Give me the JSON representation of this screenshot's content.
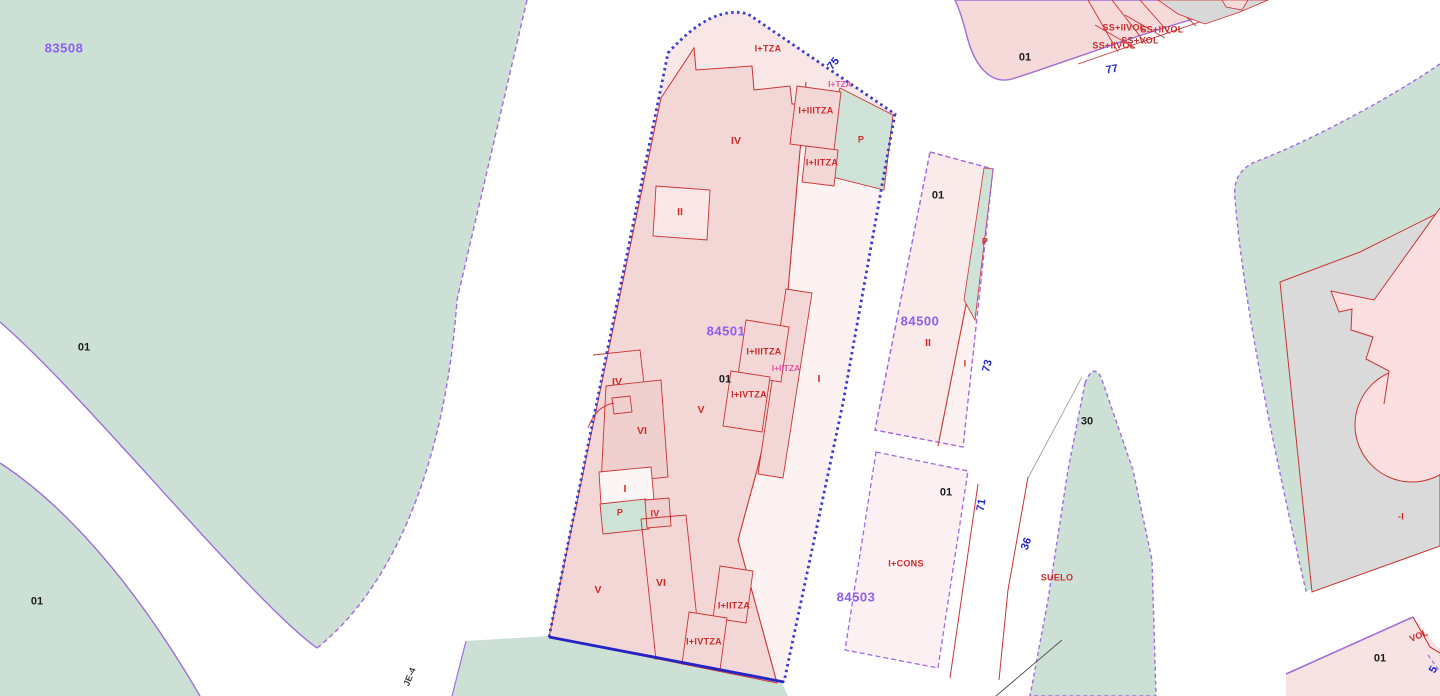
{
  "map": {
    "parcel_codes_visible": [
      "83508",
      "84501",
      "84500",
      "84503"
    ],
    "street_numbers_visible": [
      "75",
      "77",
      "73",
      "71",
      "36",
      "5"
    ],
    "street_name": "JE-4"
  },
  "colors": {
    "green_area": "#cde0d6",
    "parcel_pink_light": "#f9e7e7",
    "building_pink": "#f3d7d7",
    "building_pink_dark": "#f0cfcf",
    "strip_pink_pale": "#fdf2f2",
    "gray_parcel": "#dadada",
    "red_line": "#cc3333",
    "violet_line": "#9f6fd8",
    "selected_parcel_blue": "#3a3ad0",
    "parcel_code_purple": "#8d5ef0",
    "street_number_blue": "#2323cd",
    "magenta_label": "#e0559f"
  },
  "labels": [
    {
      "text": "83508",
      "x": 64,
      "y": 48,
      "cls": "code",
      "name": "parcel-code-label"
    },
    {
      "text": "84501",
      "x": 726,
      "y": 331,
      "cls": "code",
      "name": "parcel-code-label"
    },
    {
      "text": "84500",
      "x": 920,
      "y": 321,
      "cls": "code",
      "name": "parcel-code-label"
    },
    {
      "text": "84503",
      "x": 856,
      "y": 597,
      "cls": "code",
      "name": "parcel-code-label"
    },
    {
      "text": "01",
      "x": 84,
      "y": 348,
      "cls": "lot",
      "name": "lot-number-label"
    },
    {
      "text": "01",
      "x": 37,
      "y": 602,
      "cls": "lot",
      "name": "lot-number-label"
    },
    {
      "text": "01",
      "x": 725,
      "y": 380,
      "cls": "lot",
      "name": "lot-number-label"
    },
    {
      "text": "01",
      "x": 938,
      "y": 196,
      "cls": "lot",
      "name": "lot-number-label"
    },
    {
      "text": "01",
      "x": 946,
      "y": 493,
      "cls": "lot",
      "name": "lot-number-label"
    },
    {
      "text": "01",
      "x": 1025,
      "y": 58,
      "cls": "lot",
      "name": "lot-number-label"
    },
    {
      "text": "01",
      "x": 1380,
      "y": 659,
      "cls": "lot",
      "name": "lot-number-label"
    },
    {
      "text": "30",
      "x": 1087,
      "y": 422,
      "cls": "lot",
      "name": "lot-number-label"
    },
    {
      "text": "75",
      "x": 834,
      "y": 64,
      "cls": "street",
      "rot": -50,
      "name": "street-number-label"
    },
    {
      "text": "77",
      "x": 1112,
      "y": 70,
      "cls": "street",
      "rot": -10,
      "name": "street-number-label"
    },
    {
      "text": "73",
      "x": 988,
      "y": 366,
      "cls": "street",
      "rot": -75,
      "name": "street-number-label"
    },
    {
      "text": "71",
      "x": 982,
      "y": 505,
      "cls": "street",
      "rot": -80,
      "name": "street-number-label"
    },
    {
      "text": "36",
      "x": 1027,
      "y": 544,
      "cls": "street",
      "rot": -70,
      "name": "street-number-label"
    },
    {
      "text": "5",
      "x": 1434,
      "y": 670,
      "cls": "street",
      "rot": -60,
      "name": "street-number-label"
    },
    {
      "text": "JE-4",
      "x": 410,
      "y": 677,
      "cls": "name",
      "rot": -68,
      "name": "street-name-label"
    },
    {
      "text": "I+TZA",
      "x": 768,
      "y": 49,
      "cls": "red",
      "name": "construction-label"
    },
    {
      "text": "I+TZA",
      "x": 840,
      "y": 84,
      "cls": "magenta",
      "name": "construction-label"
    },
    {
      "text": "I+IIITZA",
      "x": 816,
      "y": 111,
      "cls": "red",
      "name": "construction-label"
    },
    {
      "text": "I+IITZA",
      "x": 822,
      "y": 163,
      "cls": "red",
      "name": "construction-label"
    },
    {
      "text": "P",
      "x": 861,
      "y": 140,
      "cls": "red",
      "name": "construction-label"
    },
    {
      "text": "IV",
      "x": 736,
      "y": 141,
      "cls": "red-lg",
      "name": "construction-label"
    },
    {
      "text": "II",
      "x": 680,
      "y": 212,
      "cls": "red-lg",
      "name": "construction-label"
    },
    {
      "text": "I+IIITZA",
      "x": 764,
      "y": 352,
      "cls": "red",
      "name": "construction-label"
    },
    {
      "text": "I+IITZA",
      "x": 786,
      "y": 368,
      "cls": "magenta",
      "name": "construction-label"
    },
    {
      "text": "I+IVTZA",
      "x": 749,
      "y": 395,
      "cls": "red",
      "name": "construction-label"
    },
    {
      "text": "V",
      "x": 701,
      "y": 410,
      "cls": "red-lg",
      "name": "construction-label"
    },
    {
      "text": "IV",
      "x": 617,
      "y": 382,
      "cls": "red-lg",
      "name": "construction-label"
    },
    {
      "text": "VI",
      "x": 642,
      "y": 431,
      "cls": "red-lg",
      "name": "construction-label"
    },
    {
      "text": "I",
      "x": 625,
      "y": 489,
      "cls": "red-lg",
      "name": "construction-label"
    },
    {
      "text": "P",
      "x": 620,
      "y": 513,
      "cls": "red",
      "name": "construction-label"
    },
    {
      "text": "IV",
      "x": 655,
      "y": 514,
      "cls": "red",
      "name": "construction-label"
    },
    {
      "text": "I",
      "x": 819,
      "y": 379,
      "cls": "red-lg",
      "name": "construction-label"
    },
    {
      "text": "V",
      "x": 598,
      "y": 590,
      "cls": "red-lg",
      "name": "construction-label"
    },
    {
      "text": "VI",
      "x": 661,
      "y": 583,
      "cls": "red-lg",
      "name": "construction-label"
    },
    {
      "text": "I+IITZA",
      "x": 734,
      "y": 606,
      "cls": "red",
      "name": "construction-label"
    },
    {
      "text": "I+IVTZA",
      "x": 704,
      "y": 642,
      "cls": "red",
      "name": "construction-label"
    },
    {
      "text": "P",
      "x": 985,
      "y": 242,
      "cls": "red",
      "name": "construction-label"
    },
    {
      "text": "II",
      "x": 928,
      "y": 343,
      "cls": "red-lg",
      "name": "construction-label"
    },
    {
      "text": "I",
      "x": 965,
      "y": 364,
      "cls": "red",
      "name": "construction-label"
    },
    {
      "text": "I+CONS",
      "x": 906,
      "y": 564,
      "cls": "red",
      "name": "construction-label"
    },
    {
      "text": "SUELO",
      "x": 1057,
      "y": 578,
      "cls": "red",
      "name": "construction-label"
    },
    {
      "text": "-I",
      "x": 1401,
      "y": 517,
      "cls": "red",
      "name": "construction-label"
    },
    {
      "text": "VOL",
      "x": 1419,
      "y": 636,
      "cls": "red",
      "rot": -22,
      "name": "construction-label"
    },
    {
      "text": "SS+IIVOL",
      "x": 1124,
      "y": 28,
      "cls": "red",
      "name": "construction-label"
    },
    {
      "text": "SS+IIVOL",
      "x": 1162,
      "y": 30,
      "cls": "red",
      "name": "construction-label"
    },
    {
      "text": "SS+VOL",
      "x": 1140,
      "y": 41,
      "cls": "red",
      "name": "construction-label"
    },
    {
      "text": "SS+IIVOL",
      "x": 1114,
      "y": 46,
      "cls": "red",
      "name": "construction-label"
    }
  ]
}
